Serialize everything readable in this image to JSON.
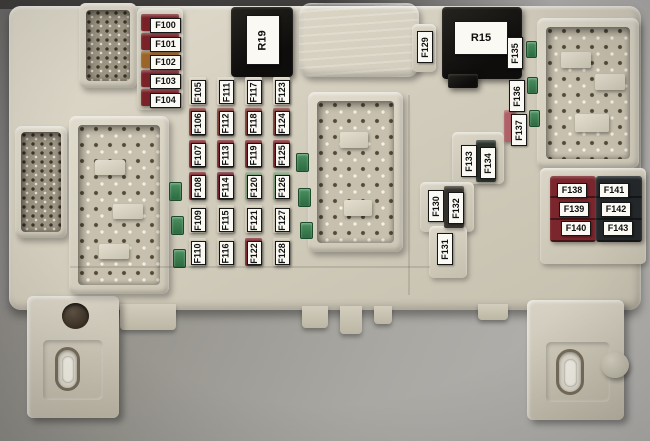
{
  "scene_title": "Automotive fuse box with labeled fuses and relays",
  "relays": {
    "r19_label": "R19",
    "r15_label": "R15"
  },
  "left_fuse_column": [
    {
      "label": "F100",
      "color": "#7a2228"
    },
    {
      "label": "F101",
      "color": "#7a2228"
    },
    {
      "label": "F102",
      "color": "#9c6426"
    },
    {
      "label": "F103",
      "color": "#7a2228"
    },
    {
      "label": "F104",
      "color": "#7a2228"
    }
  ],
  "fuse_grid": {
    "rows": [
      [
        "F105",
        "F111",
        "F117",
        "F123"
      ],
      [
        "F106",
        "F112",
        "F118",
        "F124"
      ],
      [
        "F107",
        "F113",
        "F119",
        "F125"
      ],
      [
        "F108",
        "F114",
        "F120",
        "F126"
      ],
      [
        "F109",
        "F115",
        "F121",
        "F127"
      ],
      [
        "F110",
        "F116",
        "F122",
        "F128"
      ]
    ],
    "colors": {
      "F105": "#d7d1c0",
      "F111": "#d7d1c0",
      "F117": "#d7d1c0",
      "F123": "#d7d1c0",
      "F106": "#7e3a34",
      "F112": "#7e3a34",
      "F118": "#7e3a34",
      "F124": "#7e3a34",
      "F107": "#7a262c",
      "F113": "#7a262c",
      "F119": "#7a262c",
      "F125": "#7a262c",
      "F108": "#7a262c",
      "F114": "#6d2330",
      "F120": "#7fa07a",
      "F126": "#7fa07a",
      "F109": "#cfc8b6",
      "F115": "#cfc8b6",
      "F121": "#cfc8b6",
      "F127": "#cfc8b6",
      "F110": "#cdc6b4",
      "F116": "#cdc6b4",
      "F122": "#7a262c",
      "F128": "#cdc6b4"
    }
  },
  "right_top": {
    "f129": "F129",
    "f135": "F135",
    "f136": "F136",
    "f137": "F137"
  },
  "mid_right": {
    "f133": "F133",
    "f134": "F134",
    "f130": "F130",
    "f132": "F132",
    "f131": "F131"
  },
  "bottom_right": {
    "left_column": [
      "F138",
      "F139",
      "F140"
    ],
    "right_column": [
      "F141",
      "F142",
      "F143"
    ],
    "left_color": "#7a262c",
    "right_color": "#24282a"
  },
  "palette": {
    "body_plastic": "#d6d0c0",
    "background_gray": "#a3a19e",
    "relay_black": "#141312",
    "green_fuse": "#37794b",
    "label_bg": "#faf9f3"
  }
}
